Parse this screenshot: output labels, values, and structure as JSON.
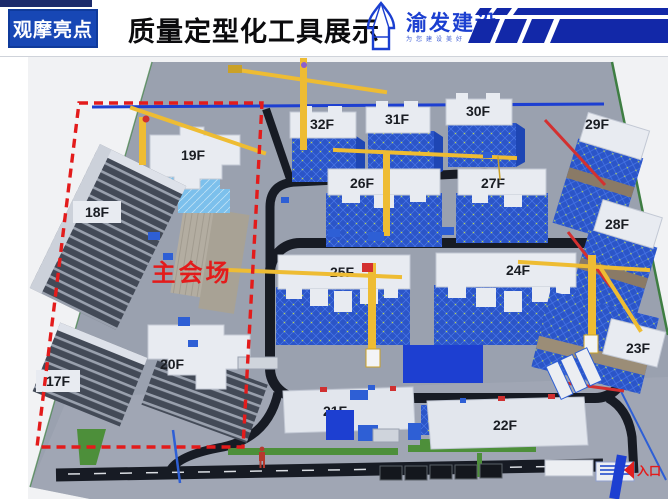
{
  "header": {
    "badge_label": "观摩亮点",
    "title": "质量定型化工具展示",
    "logo": {
      "name": "渝发建设",
      "tagline": "为您建设美好"
    }
  },
  "site": {
    "venue_label": "主会场",
    "entrance_label": "入口",
    "buildings": {
      "b17": {
        "label": "17F"
      },
      "b18": {
        "label": "18F"
      },
      "b19": {
        "label": "19F"
      },
      "b20": {
        "label": "20F"
      },
      "b21": {
        "label": "21F"
      },
      "b22": {
        "label": "22F"
      },
      "b23": {
        "label": "23F"
      },
      "b24": {
        "label": "24F"
      },
      "b25": {
        "label": "25F"
      },
      "b26": {
        "label": "26F"
      },
      "b27": {
        "label": "27F"
      },
      "b28": {
        "label": "28F"
      },
      "b29": {
        "label": "29F"
      },
      "b30": {
        "label": "30F"
      },
      "b31": {
        "label": "31F"
      },
      "b32": {
        "label": "32F"
      }
    }
  },
  "colors": {
    "badge_blue": "#1747b5",
    "logo_blue": "#1b3fd0",
    "stripe_blue": "#1228a8",
    "building_scaffold_blue": "#2b55c8",
    "roof_white": "#e8ebf1",
    "crane_yellow": "#eebc33",
    "alert_red": "#e01f1f",
    "platform_gray": "#9aa1af",
    "road_dark": "#171b24",
    "greenery": "#4d8f3a"
  }
}
